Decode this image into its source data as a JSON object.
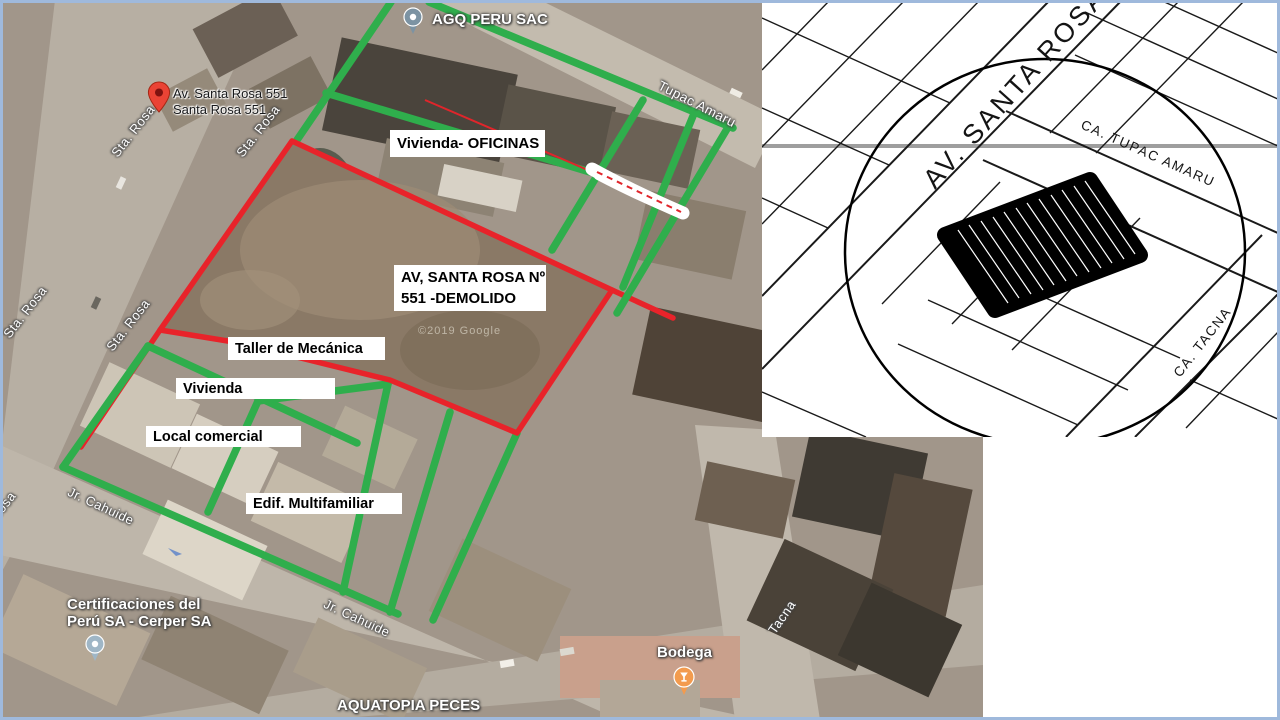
{
  "colors": {
    "annotation_red": "#e8232a",
    "annotation_green": "#2fae4c",
    "slide_border": "#9fb9dc",
    "label_box_bg": "#ffffff",
    "label_box_text": "#000000",
    "red_pin": "#ea4335",
    "gray_pin": "#7c93a3",
    "light_gray_pin": "#9fb6c6",
    "orange_pin": "#f39b4e"
  },
  "sat": {
    "watermark": "©2019 Google",
    "streets": [
      "Sta. Rosa",
      "Sta. Rosa",
      "Sta. Rosa",
      "Sta. Rosa",
      "Rosa",
      "Jr. Cahuide",
      "Jr. Cahuide",
      "Tupac Amaru",
      "Tacna"
    ],
    "boxes": {
      "vivienda_oficinas": "Vivienda- OFICINAS",
      "lot_line1": "AV, SANTA ROSA Nº",
      "lot_line2": "551 -DEMOLIDO",
      "taller": "Taller de Mecánica",
      "vivienda": "Vivienda",
      "local": "Local comercial",
      "edif": "Edif. Multifamiliar"
    },
    "pois": {
      "agq": "AGQ PERU SAC",
      "marker_line1": "Av. Santa Rosa 551",
      "marker_line2": "Santa Rosa 551",
      "cerper_line1": "Certificaciones del",
      "cerper_line2": "Perú SA - Cerper SA",
      "bodega": "Bodega",
      "aquatopia": "AQUATOPIA PECES"
    }
  },
  "inset": {
    "avenue": "AV. SANTA ROSA",
    "tupac": "CA. TUPAC AMARU",
    "tacna": "CA. TACNA"
  }
}
